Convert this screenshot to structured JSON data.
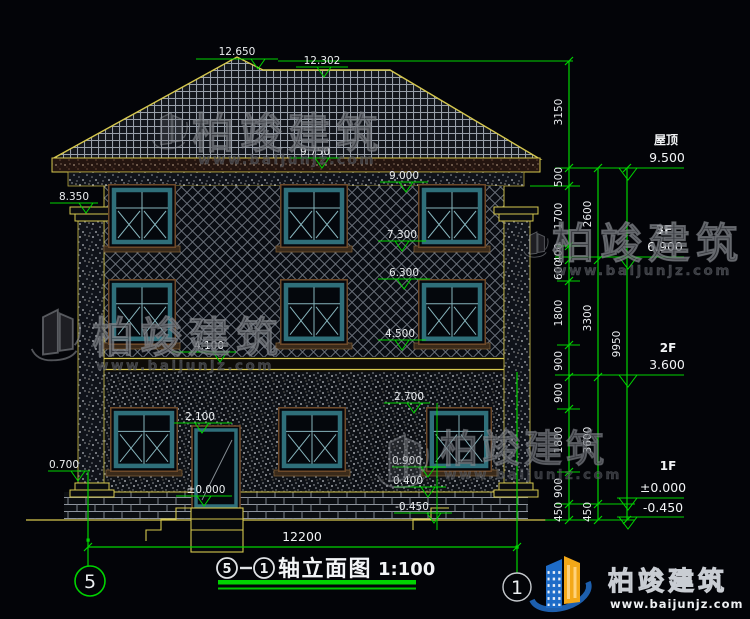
{
  "markers": {
    "ridge_left": "12.650",
    "ridge": "12.302",
    "eave": "9.750",
    "cornice": "9.000",
    "pillar_top": "8.350",
    "w3_sill": "7.300",
    "w2_head": "6.300",
    "w2_sill": "4.500",
    "belt": "4.100",
    "w1_head": "2.700",
    "door_head": "2.100",
    "floor": "±0.000",
    "w1_sill": "0.900",
    "plinth": "0.400",
    "ground": "-0.450",
    "pillar_base": "0.700"
  },
  "dims": {
    "inner": [
      "3150",
      "500",
      "1700",
      "400",
      "600",
      "1800",
      "900",
      "900",
      "1800",
      "900",
      "450"
    ],
    "mid": [
      "2600",
      "3300",
      "3600",
      "450"
    ],
    "total_height": "9950",
    "total_width": "12200"
  },
  "levels": [
    {
      "name": "屋顶",
      "value": "9.500"
    },
    {
      "name": "3F",
      "value": "6.900"
    },
    {
      "name": "2F",
      "value": "3.600"
    },
    {
      "name": "1F",
      "value": "±0.000",
      "value2": "-0.450"
    }
  ],
  "axes": {
    "left": "5",
    "right": "1"
  },
  "title": {
    "axis_left": "5",
    "axis_right": "1",
    "name": "轴立面图",
    "scale": "1:100"
  },
  "watermark": {
    "text": "柏竣建筑",
    "url": "www.baijunjz.com"
  },
  "logo": {
    "text": "柏竣建筑",
    "url": "www.baijunjz.com"
  },
  "colors": {
    "dim_green": "#00d400",
    "cad_yellow": "#d6c84e",
    "window_teal": "#2f6f7a",
    "logo_blue": "#1e6cc8",
    "logo_orange": "#f3a818"
  }
}
